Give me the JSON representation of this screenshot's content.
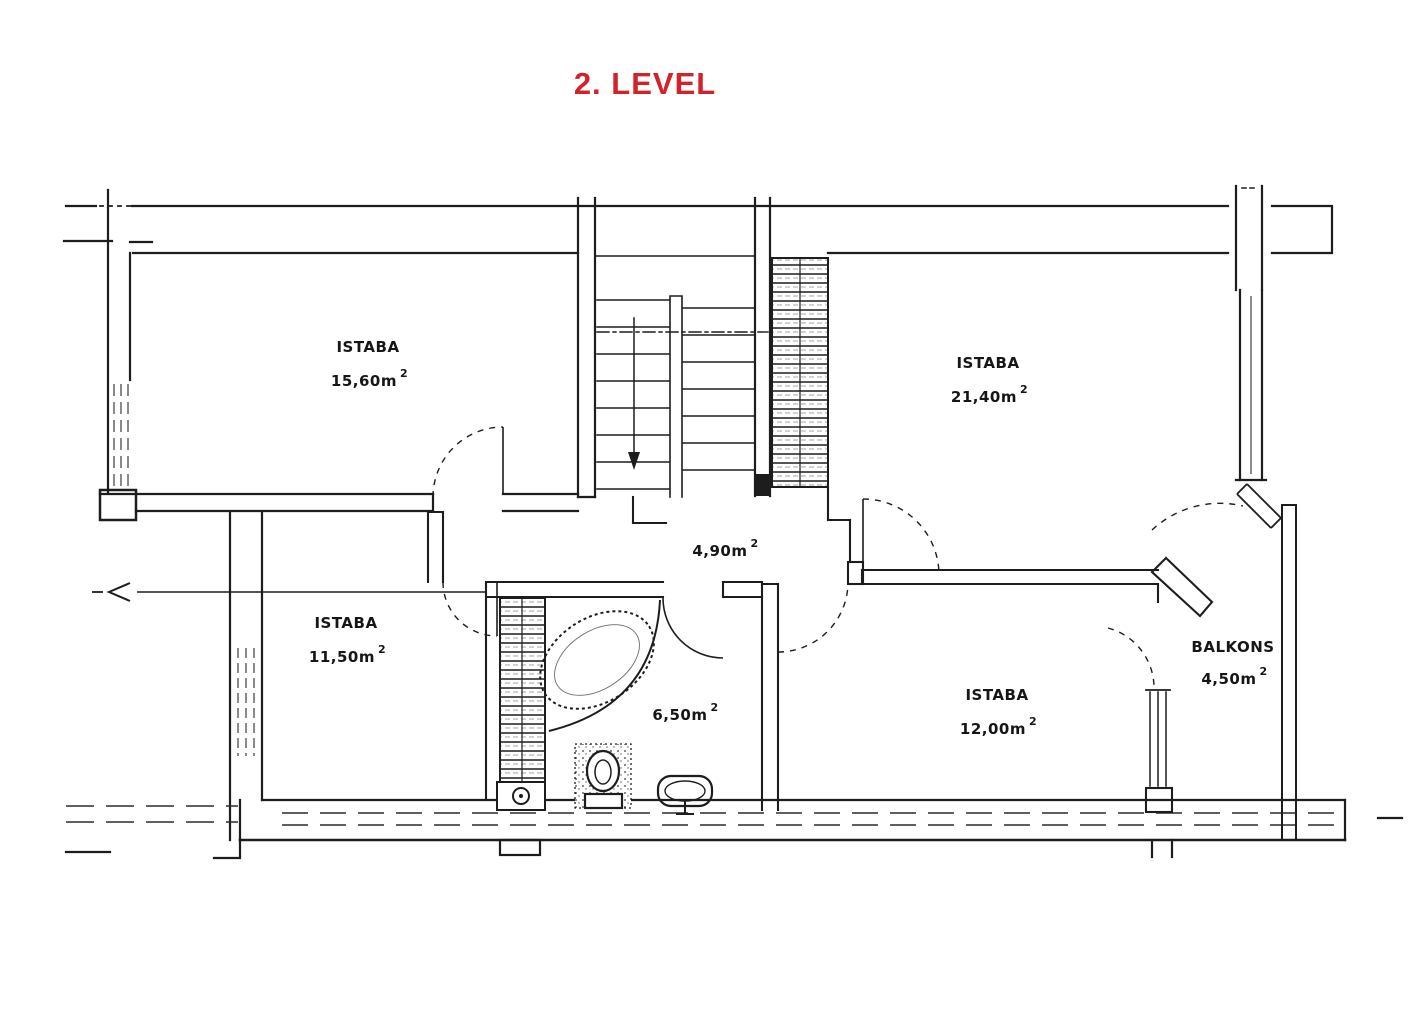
{
  "title": {
    "text": "2. LEVEL",
    "color": "#d2222a"
  },
  "plan": {
    "level_note": "2. LEVEL",
    "rooms": [
      {
        "name": "ISTABA",
        "area": "15,60m",
        "sup": "2"
      },
      {
        "name": "ISTABA",
        "area": "21,40m",
        "sup": "2"
      },
      {
        "name": "ISTABA",
        "area": "11,50m",
        "sup": "2"
      },
      {
        "name": "ISTABA",
        "area": "12,00m",
        "sup": "2"
      },
      {
        "name": "BALKONS",
        "area": "4,50m",
        "sup": "2"
      }
    ],
    "hall": {
      "area": "4,90m",
      "sup": "2"
    },
    "bathroom": {
      "area": "6,50m",
      "sup": "2"
    }
  }
}
